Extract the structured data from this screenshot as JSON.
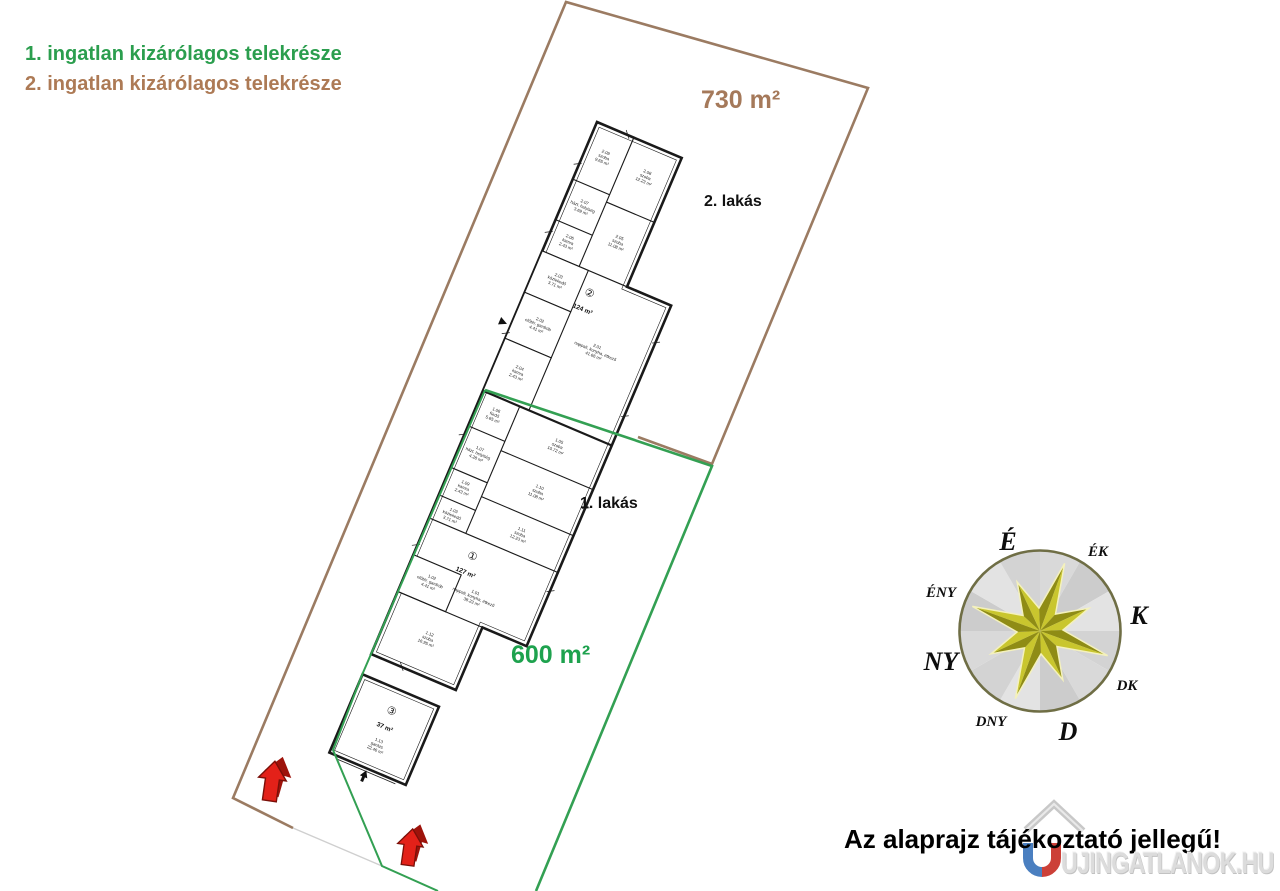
{
  "legend": {
    "item1": {
      "label": "1. ingatlan kizárólagos telekrésze",
      "color": "#2b9e4e"
    },
    "item2": {
      "label": "2. ingatlan kizárólagos telekrésze",
      "color": "#ad7a55"
    }
  },
  "plot1": {
    "area": "600 m²",
    "unit": "1. lakás",
    "boundary_color": "#33a053",
    "text_color": "#1ea24e"
  },
  "plot2": {
    "area": "730 m²",
    "unit": "2. lakás",
    "boundary_color": "#9b7b62",
    "text_color": "#a5795a"
  },
  "floorplan": {
    "unit2": {
      "badge": "②",
      "area": "124 m²",
      "living": {
        "no": "2.01",
        "name": "nappali, konyha, étkező",
        "area": "41.66 m²"
      },
      "rooms": [
        {
          "no": "2.09",
          "name": "szoba",
          "area": "9.65 m²"
        },
        {
          "no": "2.08",
          "name": "szoba",
          "area": "12.23 m²"
        },
        {
          "no": "2.07",
          "name": "házt. helyiség",
          "area": "3.69 m²"
        },
        {
          "no": "2.05",
          "name": "szoba",
          "area": "11.08 m²"
        },
        {
          "no": "2.06",
          "name": "kamra",
          "area": "2.43 m²"
        },
        {
          "no": "2.03",
          "name": "közlekedő",
          "area": "3.71 m²"
        },
        {
          "no": "2.02",
          "name": "előtér, gardrób",
          "area": "4.41 m²"
        },
        {
          "no": "2.04",
          "name": "kamra",
          "area": "2.43 m²"
        }
      ]
    },
    "unit1": {
      "badge": "①",
      "area": "127 m²",
      "living": {
        "no": "1.01",
        "name": "nappali, konyha, étkező",
        "area": "38.23 m²"
      },
      "rooms": [
        {
          "no": "1.06",
          "name": "fürdő",
          "area": "5.65 m²"
        },
        {
          "no": "1.05",
          "name": "szoba",
          "area": "10.72 m²"
        },
        {
          "no": "1.07",
          "name": "házt. helyiség",
          "area": "4.28 m²"
        },
        {
          "no": "1.10",
          "name": "szoba",
          "area": "11.08 m²"
        },
        {
          "no": "1.09",
          "name": "kamra",
          "area": "2.43 m²"
        },
        {
          "no": "1.11",
          "name": "szoba",
          "area": "12.23 m²"
        },
        {
          "no": "1.03",
          "name": "közlekedő",
          "area": "3.71 m²"
        },
        {
          "no": "1.02",
          "name": "előtér, gardrób",
          "area": "4.41 m²"
        },
        {
          "no": "1.12",
          "name": "szoba",
          "area": "16.95 m²"
        }
      ]
    },
    "garage": {
      "badge": "③",
      "area": "37 m²",
      "room": {
        "no": "1.13",
        "name": "garázs",
        "area": "22.46 m²"
      }
    }
  },
  "compass": {
    "directions": [
      {
        "label": "É"
      },
      {
        "label": "ÉK"
      },
      {
        "label": "K"
      },
      {
        "label": "DK"
      },
      {
        "label": "D"
      },
      {
        "label": "DNY"
      },
      {
        "label": "NY"
      },
      {
        "label": "ÉNY"
      }
    ],
    "star_color": "#a8a51e"
  },
  "footer": {
    "disclaimer": "Az alaprajz tájékoztató jellegű!",
    "watermark": "UJINGATLANOK.HU"
  }
}
